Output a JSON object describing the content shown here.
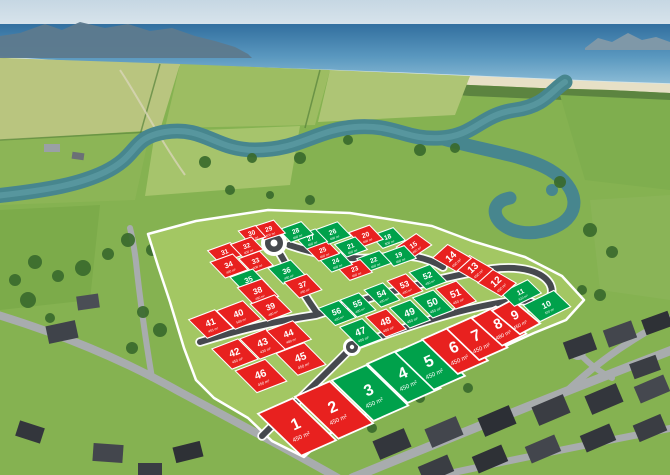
{
  "image_type": "aerial-subdivision-lot-map",
  "palette": {
    "sold": "#e8211f",
    "available": "#00a14b",
    "lot_outline": "#ffffff",
    "boundary_outline": "#ffffff",
    "river": "#47868e",
    "grass": "#a3c763"
  },
  "legend": {
    "red_means": "sold",
    "green_means": "available"
  },
  "lots": [
    {
      "n": "1",
      "area": "450 m²",
      "status": "sold",
      "x": 297,
      "y": 427,
      "w": 38,
      "h": 56,
      "r": -24,
      "k": 22
    },
    {
      "n": "2",
      "area": "450 m²",
      "status": "sold",
      "x": 334,
      "y": 410,
      "w": 38,
      "h": 56,
      "r": -24,
      "k": 22
    },
    {
      "n": "3",
      "area": "450 m²",
      "status": "available",
      "x": 370,
      "y": 393,
      "w": 38,
      "h": 54,
      "r": -24,
      "k": 22
    },
    {
      "n": "4",
      "area": "450 m²",
      "status": "available",
      "x": 404,
      "y": 376,
      "w": 36,
      "h": 52,
      "r": -24,
      "k": 22
    },
    {
      "n": "5",
      "area": "450 m²",
      "status": "available",
      "x": 430,
      "y": 364,
      "w": 34,
      "h": 50,
      "r": -24,
      "k": 22
    },
    {
      "n": "6",
      "area": "450 m²",
      "status": "sold",
      "x": 455,
      "y": 350,
      "w": 33,
      "h": 46,
      "r": -24,
      "k": 22
    },
    {
      "n": "7",
      "area": "450 m²",
      "status": "sold",
      "x": 477,
      "y": 338,
      "w": 31,
      "h": 42,
      "r": -24,
      "k": 22
    },
    {
      "n": "8",
      "area": "480 m²",
      "status": "sold",
      "x": 499,
      "y": 326,
      "w": 27,
      "h": 38,
      "r": -26,
      "k": 22
    },
    {
      "n": "9",
      "area": "450 m²",
      "status": "sold",
      "x": 516,
      "y": 317,
      "w": 23,
      "h": 34,
      "r": -28,
      "k": 22
    },
    {
      "n": "10",
      "area": "520 m²",
      "status": "available",
      "x": 547,
      "y": 306,
      "w": 34,
      "h": 22,
      "r": -26,
      "k": 20
    },
    {
      "n": "11",
      "area": "610 m²",
      "status": "available",
      "x": 521,
      "y": 293,
      "w": 30,
      "h": 18,
      "r": -26,
      "k": 20
    },
    {
      "n": "12",
      "area": "450 m²",
      "status": "sold",
      "x": 497,
      "y": 283,
      "w": 20,
      "h": 26,
      "r": -42,
      "k": 18
    },
    {
      "n": "13",
      "area": "450 m²",
      "status": "sold",
      "x": 474,
      "y": 269,
      "w": 20,
      "h": 26,
      "r": -42,
      "k": 18
    },
    {
      "n": "14",
      "area": "450 m²",
      "status": "sold",
      "x": 452,
      "y": 258,
      "w": 20,
      "h": 26,
      "r": -42,
      "k": 18
    },
    {
      "n": "15",
      "area": "450 m²",
      "status": "sold",
      "x": 414,
      "y": 246,
      "w": 24,
      "h": 18,
      "r": -34,
      "k": 20
    },
    {
      "n": "18",
      "area": "500 m²",
      "status": "available",
      "x": 388,
      "y": 238,
      "w": 24,
      "h": 16,
      "r": -20,
      "k": 24
    },
    {
      "n": "19",
      "area": "450 m²",
      "status": "available",
      "x": 399,
      "y": 256,
      "w": 24,
      "h": 16,
      "r": -20,
      "k": 24
    },
    {
      "n": "20",
      "area": "450 m²",
      "status": "sold",
      "x": 366,
      "y": 236,
      "w": 22,
      "h": 18,
      "r": -20,
      "k": 24
    },
    {
      "n": "21",
      "area": "450 m²",
      "status": "available",
      "x": 351,
      "y": 247,
      "w": 22,
      "h": 16,
      "r": -20,
      "k": 24
    },
    {
      "n": "22",
      "area": "450 m²",
      "status": "available",
      "x": 374,
      "y": 261,
      "w": 24,
      "h": 16,
      "r": -20,
      "k": 24
    },
    {
      "n": "23",
      "area": "450 m²",
      "status": "sold",
      "x": 355,
      "y": 270,
      "w": 24,
      "h": 16,
      "r": -20,
      "k": 24
    },
    {
      "n": "24",
      "area": "450 m²",
      "status": "available",
      "x": 336,
      "y": 262,
      "w": 22,
      "h": 16,
      "r": -20,
      "k": 24
    },
    {
      "n": "25",
      "area": "450 m²",
      "status": "sold",
      "x": 323,
      "y": 251,
      "w": 22,
      "h": 16,
      "r": -20,
      "k": 24
    },
    {
      "n": "26",
      "area": "450 m²",
      "status": "available",
      "x": 333,
      "y": 233,
      "w": 24,
      "h": 18,
      "r": -20,
      "k": 24
    },
    {
      "n": "27",
      "area": "450 m²",
      "status": "available",
      "x": 311,
      "y": 239,
      "w": 22,
      "h": 16,
      "r": -20,
      "k": 24
    },
    {
      "n": "28",
      "area": "450 m²",
      "status": "available",
      "x": 296,
      "y": 232,
      "w": 24,
      "h": 16,
      "r": -20,
      "k": 24
    },
    {
      "n": "29",
      "area": "400 m²",
      "status": "sold",
      "x": 269,
      "y": 230,
      "w": 22,
      "h": 16,
      "r": -18,
      "k": 24
    },
    {
      "n": "30",
      "area": "400 m²",
      "status": "sold",
      "x": 252,
      "y": 234,
      "w": 18,
      "h": 14,
      "r": -18,
      "k": 24
    },
    {
      "n": "31",
      "area": "400 m²",
      "status": "sold",
      "x": 225,
      "y": 253,
      "w": 24,
      "h": 16,
      "r": -20,
      "k": 24
    },
    {
      "n": "32",
      "area": "400 m²",
      "status": "sold",
      "x": 247,
      "y": 247,
      "w": 22,
      "h": 16,
      "r": -20,
      "k": 24
    },
    {
      "n": "33",
      "area": "400 m²",
      "status": "sold",
      "x": 256,
      "y": 262,
      "w": 22,
      "h": 18,
      "r": -20,
      "k": 24
    },
    {
      "n": "34",
      "area": "420 m²",
      "status": "sold",
      "x": 229,
      "y": 266,
      "w": 24,
      "h": 20,
      "r": -20,
      "k": 24
    },
    {
      "n": "35",
      "area": "400 m²",
      "status": "available",
      "x": 249,
      "y": 281,
      "w": 24,
      "h": 20,
      "r": -20,
      "k": 24
    },
    {
      "n": "36",
      "area": "450 m²",
      "status": "available",
      "x": 287,
      "y": 272,
      "w": 24,
      "h": 20,
      "r": -20,
      "k": 24
    },
    {
      "n": "37",
      "area": "450 m²",
      "status": "sold",
      "x": 303,
      "y": 286,
      "w": 24,
      "h": 20,
      "r": -20,
      "k": 24
    },
    {
      "n": "38",
      "area": "450 m²",
      "status": "sold",
      "x": 258,
      "y": 292,
      "w": 26,
      "h": 22,
      "r": -20,
      "k": 24
    },
    {
      "n": "39",
      "area": "480 m²",
      "status": "sold",
      "x": 271,
      "y": 308,
      "w": 26,
      "h": 22,
      "r": -21,
      "k": 24
    },
    {
      "n": "40",
      "area": "500 m²",
      "status": "sold",
      "x": 239,
      "y": 315,
      "w": 28,
      "h": 24,
      "r": -21,
      "k": 24
    },
    {
      "n": "41",
      "area": "455 m²",
      "status": "sold",
      "x": 211,
      "y": 324,
      "w": 28,
      "h": 24,
      "r": -21,
      "k": 24
    },
    {
      "n": "42",
      "area": "450 m²",
      "status": "sold",
      "x": 235,
      "y": 354,
      "w": 28,
      "h": 26,
      "r": -21,
      "k": 24
    },
    {
      "n": "43",
      "area": "430 m²",
      "status": "sold",
      "x": 263,
      "y": 344,
      "w": 28,
      "h": 26,
      "r": -21,
      "k": 24
    },
    {
      "n": "44",
      "area": "480 m²",
      "status": "sold",
      "x": 289,
      "y": 335,
      "w": 28,
      "h": 24,
      "r": -21,
      "k": 24
    },
    {
      "n": "45",
      "area": "450 m²",
      "status": "sold",
      "x": 301,
      "y": 359,
      "w": 30,
      "h": 28,
      "r": -21,
      "k": 24
    },
    {
      "n": "46",
      "area": "450 m²",
      "status": "sold",
      "x": 261,
      "y": 376,
      "w": 32,
      "h": 28,
      "r": -21,
      "k": 24
    },
    {
      "n": "47",
      "area": "400 m²",
      "status": "available",
      "x": 361,
      "y": 333,
      "w": 24,
      "h": 26,
      "r": -21,
      "k": 24
    },
    {
      "n": "48",
      "area": "400 m²",
      "status": "sold",
      "x": 386,
      "y": 323,
      "w": 22,
      "h": 26,
      "r": -21,
      "k": 24
    },
    {
      "n": "49",
      "area": "450 m²",
      "status": "available",
      "x": 410,
      "y": 314,
      "w": 22,
      "h": 26,
      "r": -21,
      "k": 24
    },
    {
      "n": "50",
      "area": "450 m²",
      "status": "available",
      "x": 433,
      "y": 304,
      "w": 22,
      "h": 26,
      "r": -21,
      "k": 24
    },
    {
      "n": "51",
      "area": "450 m²",
      "status": "sold",
      "x": 456,
      "y": 295,
      "w": 22,
      "h": 26,
      "r": -21,
      "k": 24
    },
    {
      "n": "52",
      "area": "450 m²",
      "status": "available",
      "x": 428,
      "y": 277,
      "w": 22,
      "h": 22,
      "r": -21,
      "k": 24
    },
    {
      "n": "53",
      "area": "400 m²",
      "status": "sold",
      "x": 405,
      "y": 286,
      "w": 20,
      "h": 22,
      "r": -21,
      "k": 24
    },
    {
      "n": "54",
      "area": "400 m²",
      "status": "available",
      "x": 382,
      "y": 295,
      "w": 20,
      "h": 22,
      "r": -21,
      "k": 24
    },
    {
      "n": "55",
      "area": "400 m²",
      "status": "available",
      "x": 358,
      "y": 305,
      "w": 20,
      "h": 22,
      "r": -21,
      "k": 24
    },
    {
      "n": "56",
      "area": "400 m²",
      "status": "available",
      "x": 337,
      "y": 313,
      "w": 22,
      "h": 22,
      "r": -21,
      "k": 24
    }
  ]
}
